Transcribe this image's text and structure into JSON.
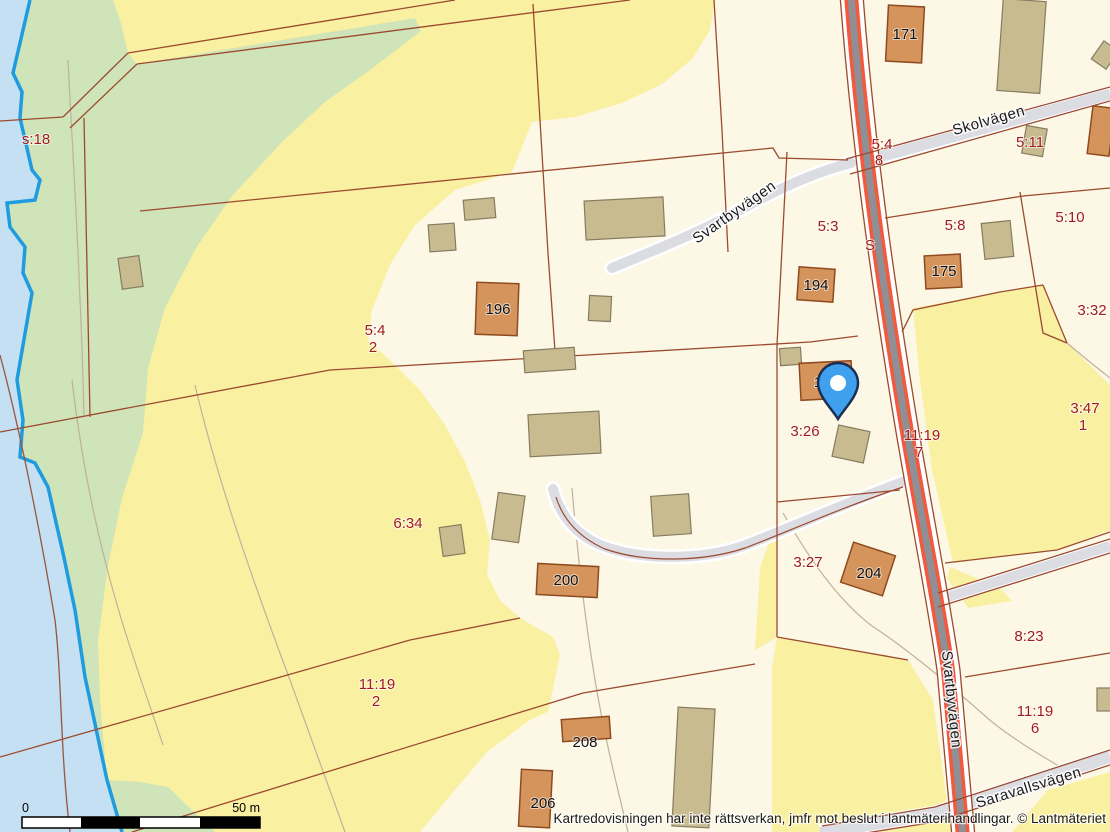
{
  "map": {
    "attribution": "Kartredovisningen har inte rättsverkan, jmfr mot beslut i lantmäterihandlingar. © Lantmäteriet",
    "scalebar": {
      "zero": "0",
      "max": "50 m"
    },
    "roads": {
      "skolvagen": "Skolvägen",
      "svartbyvagen_upper": "Svartbyvägen",
      "svartbyvagen_lower": "Svartbyvägen",
      "saravallsvagen": "Saravallsvägen"
    },
    "parcels": {
      "s18": "s:18",
      "p54_2_1": "5:4",
      "p54_2_2": "2",
      "p634": "6:34",
      "p1119_2_1": "11:19",
      "p1119_2_2": "2",
      "p54_8_1": "5:4",
      "p54_8_2": "8",
      "p53": "5:3",
      "s_marker": "S",
      "p58": "5:8",
      "p511": "5:11",
      "p510": "5:10",
      "p332": "3:32",
      "p347_1": "3:47",
      "p347_2": "1",
      "p326": "3:26",
      "p1119_7_1": "11:19",
      "p1119_7_2": "7",
      "p327": "3:27",
      "p823": "8:23",
      "p1119_6_1": "11:19",
      "p1119_6_2": "6"
    },
    "buildings": {
      "b171": "171",
      "b194": "194",
      "b175": "175",
      "b196": "196",
      "b200": "200",
      "b204": "204",
      "b206": "206",
      "b208": "208",
      "b_pin": "1"
    },
    "colors": {
      "water": "#C5E0F2",
      "shoreline": "#1F9BE0",
      "green": "#CFE4B8",
      "yellow": "#FAF0A2",
      "cream": "#FCF8E5",
      "road_fill": "#DCDCE3",
      "main_road_core": "#8F8F96",
      "main_road_edge": "#F2593D",
      "parcel_line": "#9C4A2F",
      "building_orange": "#D4945C",
      "building_tan": "#C9BB90",
      "label_red": "#A11B1B",
      "pin_blue": "#3FA1ED"
    }
  }
}
